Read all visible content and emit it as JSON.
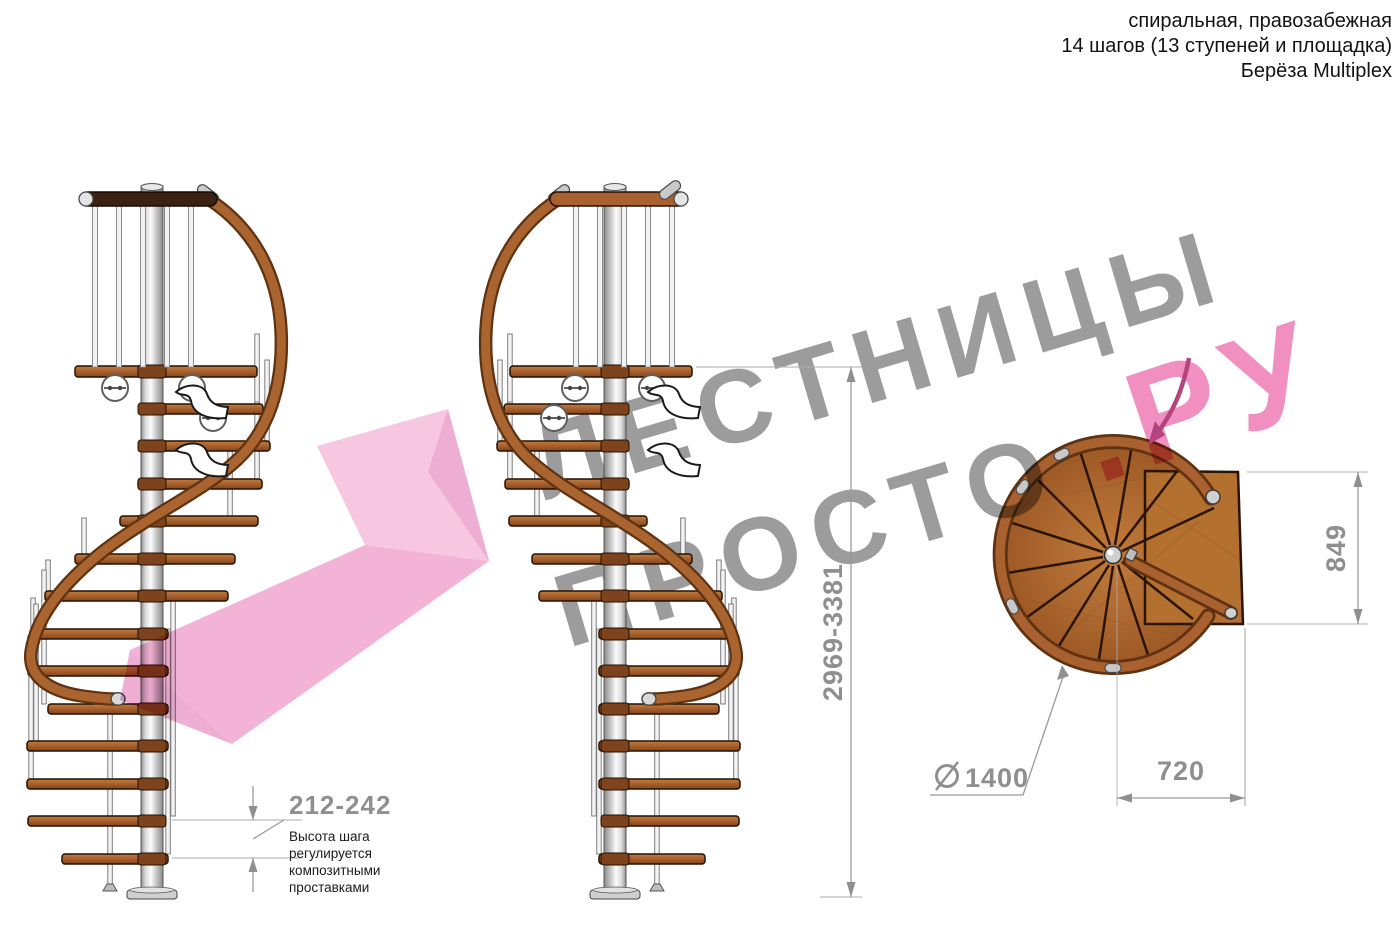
{
  "header": {
    "line1": "спиральная, правозабежная",
    "line2": "14 шагов (13 ступеней и площадка)",
    "line3": "Берёза Multiplex"
  },
  "watermark": {
    "word1": "ЛЕСТНИЦЫ",
    "word2": "ПРОСТО",
    "word3": ".РУ",
    "gray_color": "#9c9c9c",
    "pink_color": "#f08fc0"
  },
  "dimensions": {
    "step_height": "212-242",
    "total_height": "2969-3381",
    "landing_depth": "849",
    "going_width": "720",
    "diameter_value": "1400",
    "diameter_symbol": "⌀"
  },
  "notes": {
    "step_height_note": {
      "lines": [
        "Высота шага",
        "регулируется",
        "композитными",
        "проставками"
      ]
    }
  },
  "colors": {
    "wood": "#a9622f",
    "wood_dark": "#5f3212",
    "pole_gray": "#cfcfcf",
    "dimension_gray": "#8f8f8f",
    "arrow_pink": "#f3aed4"
  }
}
